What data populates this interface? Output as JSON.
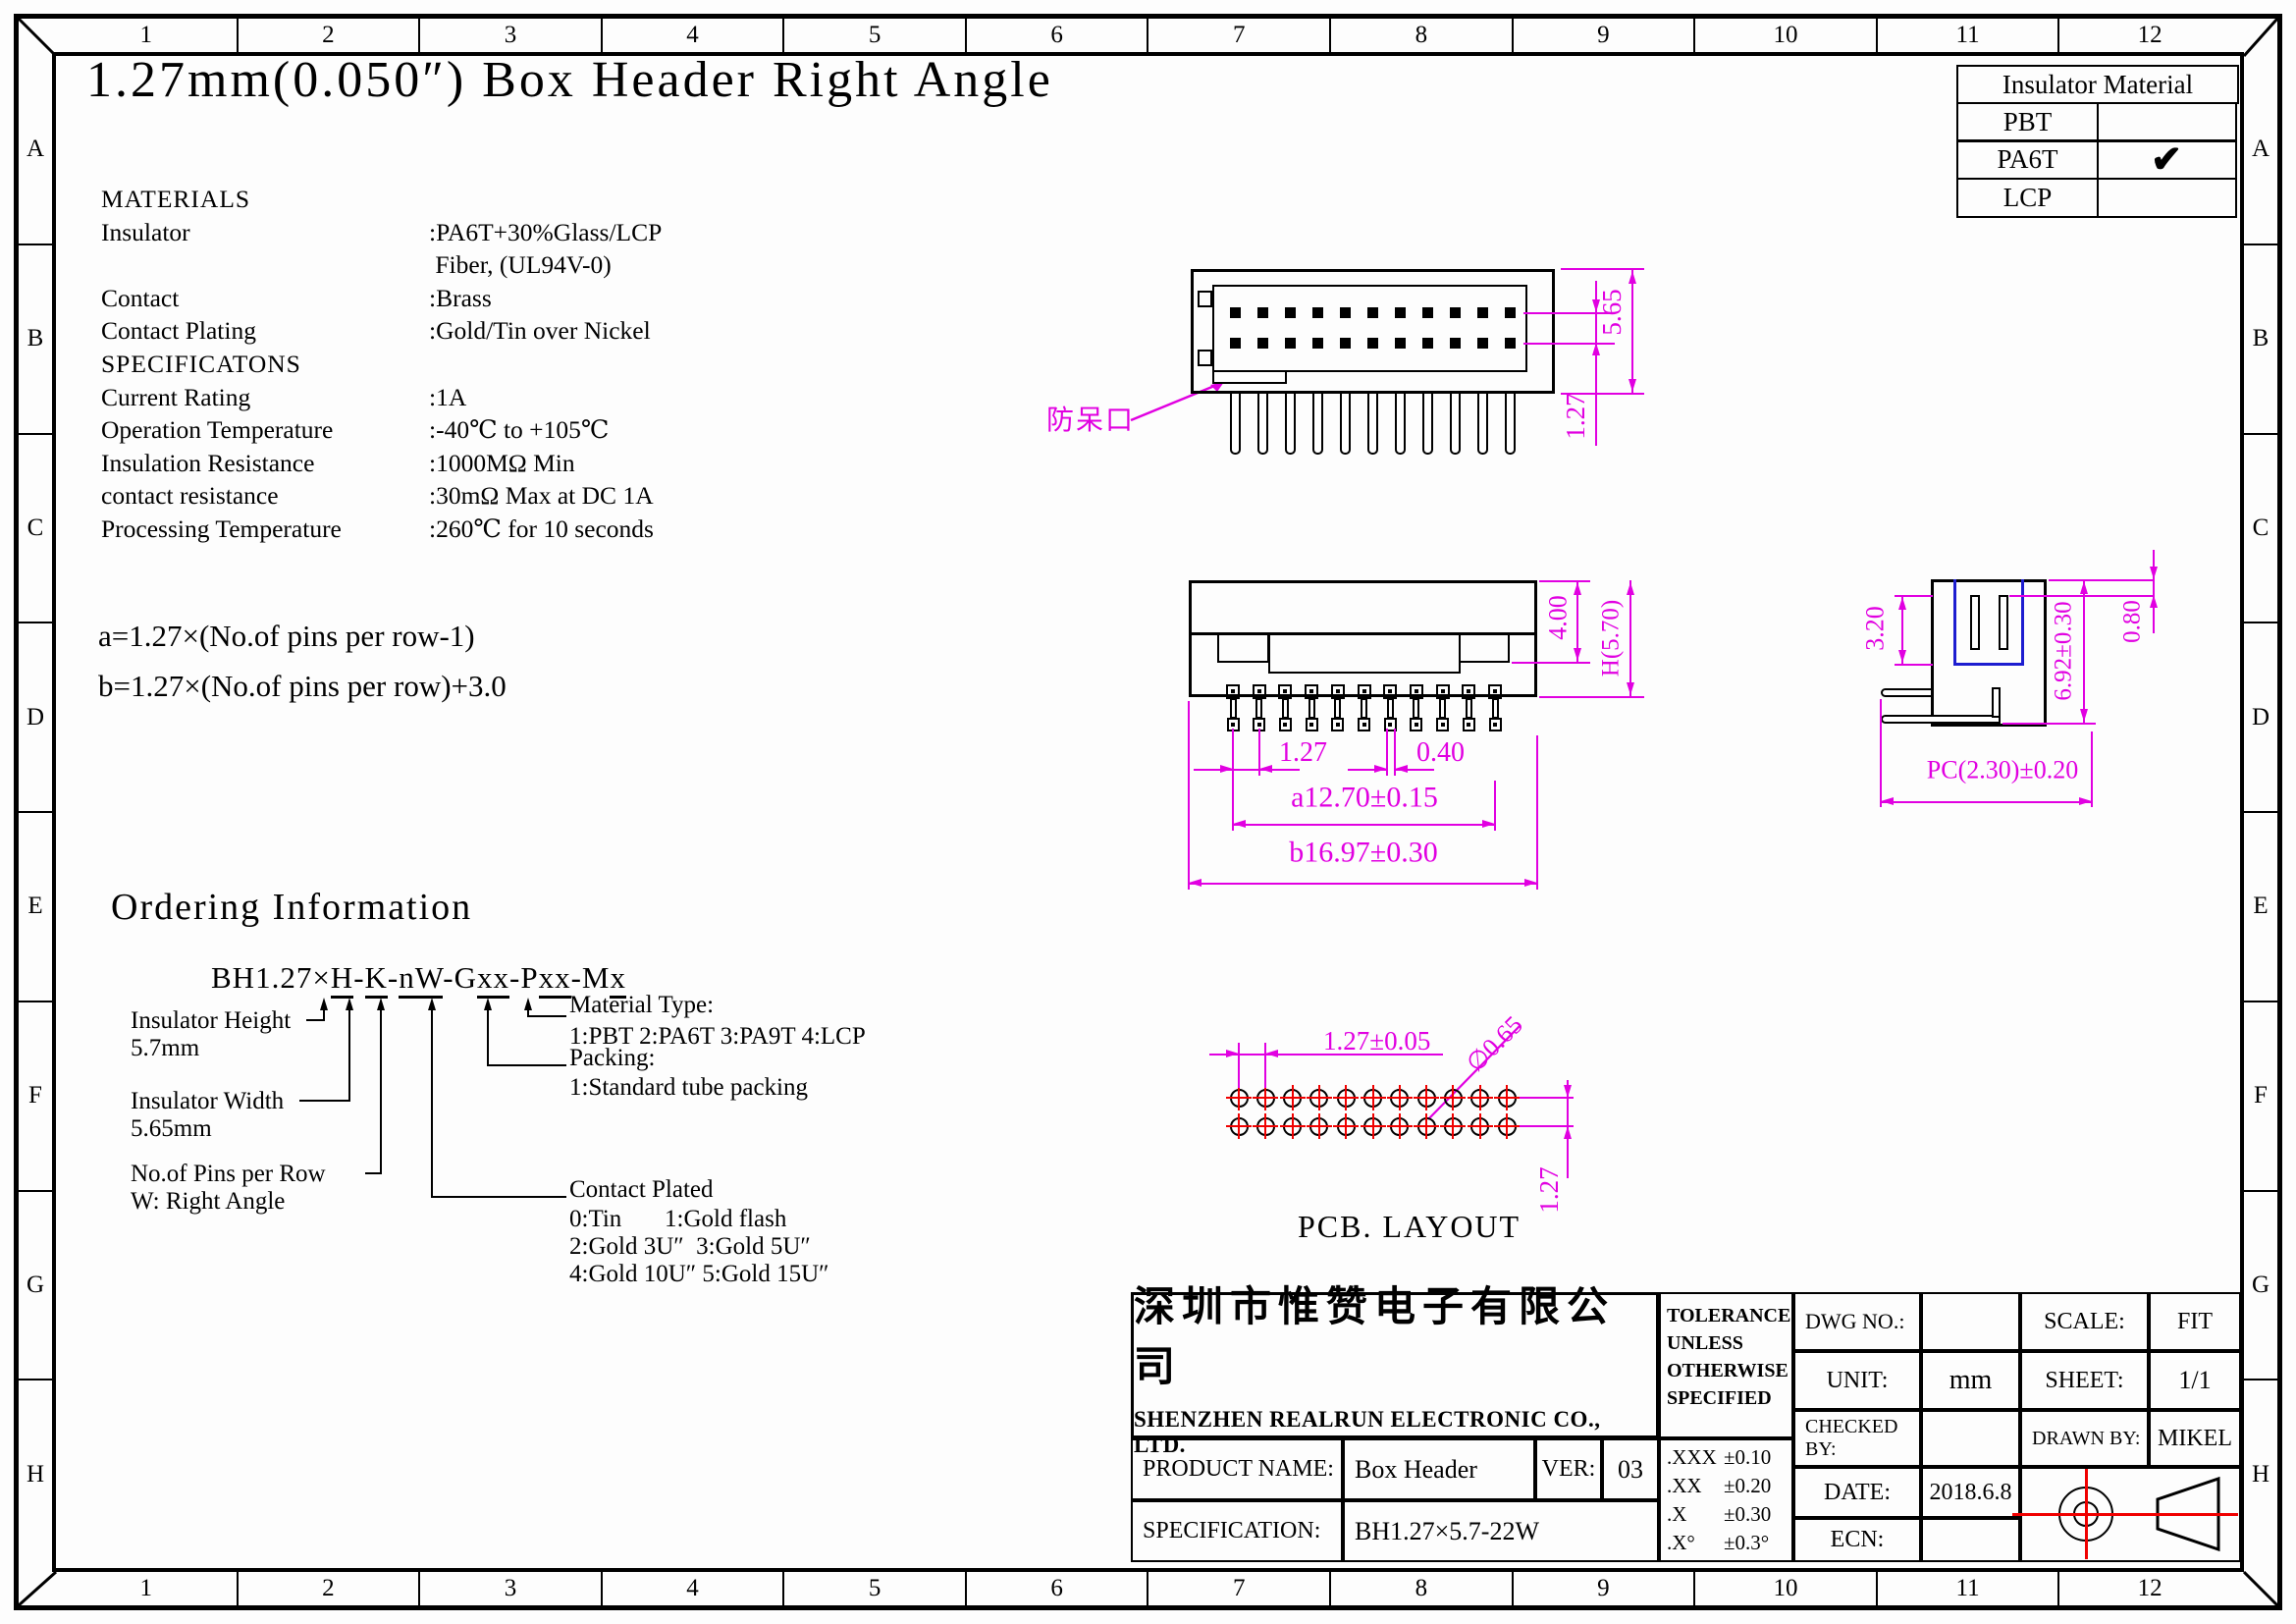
{
  "sheet": {
    "title": "1.27mm(0.050″) Box Header Right Angle",
    "zone_cols": [
      "1",
      "2",
      "3",
      "4",
      "5",
      "6",
      "7",
      "8",
      "9",
      "10",
      "11",
      "12"
    ],
    "zone_rows": [
      "A",
      "B",
      "C",
      "D",
      "E",
      "F",
      "G",
      "H"
    ]
  },
  "insulator_table": {
    "header": "Insulator Material",
    "check_glyph": "✔",
    "rows": [
      {
        "name": "PBT",
        "checked": false
      },
      {
        "name": "PA6T",
        "checked": true
      },
      {
        "name": "LCP",
        "checked": false
      }
    ]
  },
  "materials": {
    "title": "MATERIALS",
    "items": [
      [
        "Insulator",
        ":PA6T+30%Glass/LCP"
      ],
      [
        "",
        " Fiber, (UL94V-0)"
      ],
      [
        "Contact",
        ":Brass"
      ],
      [
        "Contact Plating",
        ":Gold/Tin over Nickel"
      ]
    ],
    "spec_title": "SPECIFICATONS",
    "spec_items": [
      [
        "Current Rating",
        ":1A"
      ],
      [
        "Operation Temperature",
        ":-40℃ to +105℃"
      ],
      [
        "Insulation Resistance",
        ":1000MΩ Min"
      ],
      [
        "contact resistance",
        ":30mΩ Max at DC 1A"
      ],
      [
        "Processing Temperature",
        ":260℃ for 10 seconds"
      ]
    ]
  },
  "formulas": {
    "a": "a=1.27×(No.of pins per row-1)",
    "b": "b=1.27×(No.of pins per row)+3.0"
  },
  "views": {
    "front": {
      "keying_label": "防呆口",
      "dim_height": "5.65",
      "dim_row_pitch": "1.27",
      "pins_per_row": 11,
      "pin_rows": 2
    },
    "bottom": {
      "dim_step_height": "4.00",
      "dim_total_height": "H(5.70)",
      "dim_pitch": "1.27",
      "dim_pin_width": "0.40",
      "dim_a": "a12.70±0.15",
      "dim_b": "b16.97±0.30"
    },
    "side": {
      "dim_cavity_depth": "3.20",
      "dim_height": "6.92±0.30",
      "dim_top": "0.80",
      "dim_pc": "PC(2.30)±0.20"
    },
    "pcb": {
      "title": "PCB. LAYOUT",
      "dim_pitch": "1.27±0.05",
      "dim_hole": "∅0.65",
      "dim_row_pitch": "1.27",
      "hole_cols": 11,
      "hole_rows": 2
    }
  },
  "ordering": {
    "heading": "Ordering Information",
    "part_segments": [
      {
        "t": "BH1.27×",
        "u": 0
      },
      {
        "t": "H",
        "u": 1
      },
      {
        "t": "-",
        "u": 0
      },
      {
        "t": "K",
        "u": 1
      },
      {
        "t": "-",
        "u": 0
      },
      {
        "t": "nW",
        "u": 1
      },
      {
        "t": "-G",
        "u": 0
      },
      {
        "t": "xx",
        "u": 1
      },
      {
        "t": "-P",
        "u": 0
      },
      {
        "t": "xx",
        "u": 1
      },
      {
        "t": "-M",
        "u": 0
      },
      {
        "t": "x",
        "u": 1
      }
    ],
    "left_labels": [
      {
        "line1": "Insulator Height",
        "line2": "5.7mm"
      },
      {
        "line1": "Insulator Width",
        "line2": "5.65mm"
      },
      {
        "line1": "No.of Pins per Row",
        "line2": "W: Right Angle"
      }
    ],
    "right_labels": {
      "material_title": "Material Type:",
      "material_line": "1:PBT 2:PA6T 3:PA9T 4:LCP",
      "packing_title": "Packing:",
      "packing_line": "1:Standard tube packing",
      "plating_title": "Contact Plated",
      "plating_line1": "0:Tin       1:Gold flash",
      "plating_line2": "2:Gold 3U″  3:Gold 5U″",
      "plating_line3": "4:Gold 10U″ 5:Gold 15U″"
    }
  },
  "title_block": {
    "company_cn": "深圳市惟赞电子有限公司",
    "company_en": "SHENZHEN REALRUN ELECTRONIC CO., LTD.",
    "product_name_label": "PRODUCT NAME:",
    "product_name": "Box Header",
    "ver_label": "VER:",
    "ver": "03",
    "spec_label": "SPECIFICATION:",
    "spec": "BH1.27×5.7-22W",
    "tolerance_heading": "TOLERANCE UNLESS OTHERWISE SPECIFIED",
    "tolerances": [
      {
        "dec": ".XXX",
        "tol": "±0.10"
      },
      {
        "dec": ".XX",
        "tol": "±0.20"
      },
      {
        "dec": ".X",
        "tol": "±0.30"
      },
      {
        "dec": ".X°",
        "tol": "±0.3°"
      }
    ],
    "dwg_no_label": "DWG NO.:",
    "dwg_no": "",
    "unit_label": "UNIT:",
    "unit": "mm",
    "checked_by_label": "CHECKED BY:",
    "checked_by": "",
    "date_label": "DATE:",
    "date": "2018.6.8",
    "ecn_label": "ECN:",
    "ecn": "",
    "scale_label": "SCALE:",
    "scale": "FIT",
    "sheet_label": "SHEET:",
    "sheet": "1/1",
    "drawn_by_label": "DRAWN BY:",
    "drawn_by": "MIKEL"
  },
  "colors": {
    "dim_magenta": "#e100e1",
    "crosshair_red": "#f00000",
    "cavity_blue": "#1d1dd0",
    "line_black": "#000000"
  }
}
